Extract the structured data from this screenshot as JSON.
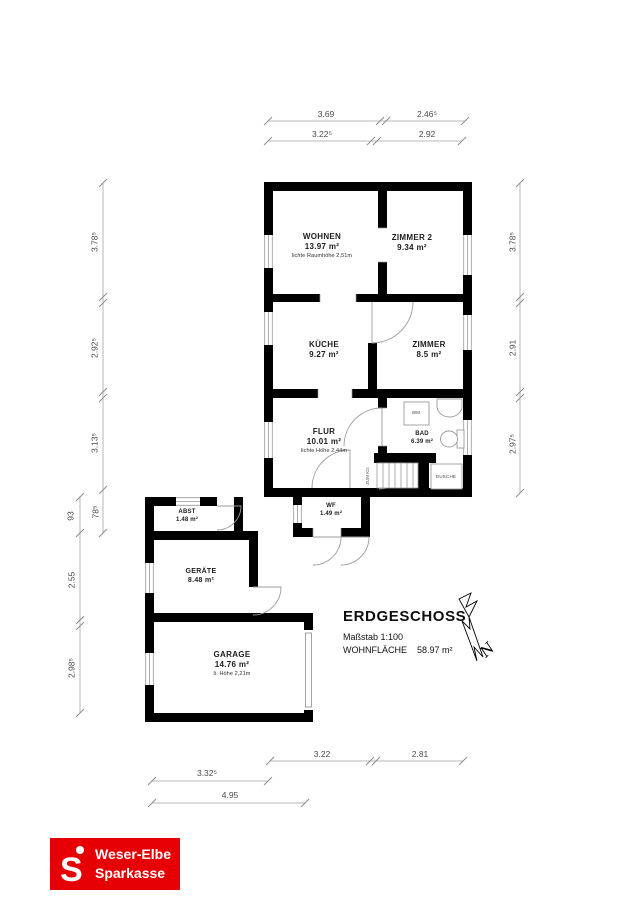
{
  "title_block": {
    "title": "ERDGESCHOSS",
    "scale": "Maßstab 1:100",
    "area_label": "WOHNFLÄCHE",
    "area_value": "58.97 m²"
  },
  "north_label": "N",
  "rooms": {
    "wohnen": {
      "name": "WOHNEN",
      "area": "13.97 m²",
      "note": "lichte Raumhöhe 2,51m"
    },
    "zimmer2": {
      "name": "ZIMMER 2",
      "area": "9.34 m²"
    },
    "kueche": {
      "name": "KÜCHE",
      "area": "9.27 m²"
    },
    "zimmer": {
      "name": "ZIMMER",
      "area": "8.5 m²"
    },
    "flur": {
      "name": "FLUR",
      "area": "10.01 m²",
      "note": "lichte Höhe 2,44m"
    },
    "bad": {
      "name": "BAD",
      "area": "6.39 m²"
    },
    "wf": {
      "name": "WF",
      "area": "1.49 m²"
    },
    "abst": {
      "name": "ABST",
      "area": "1.48 m²"
    },
    "geraete": {
      "name": "GERÄTE",
      "area": "8.48 m²"
    },
    "garage": {
      "name": "GARAGE",
      "area": "14.76 m²",
      "note": "li. Höhe 2,21m"
    }
  },
  "fixtures": {
    "washer": "WM",
    "shower": "DUSCHE",
    "stairs_note": "ZUM KG"
  },
  "dimensions": {
    "top_row1": [
      "3.69",
      "2.46⁵"
    ],
    "top_row2": [
      "3.22⁵",
      "2.92"
    ],
    "left_outer": [
      "3.78⁵",
      "2.92⁵",
      "3.13⁵",
      "78⁵"
    ],
    "left_inner": [
      "93",
      "2.55",
      "2.98⁵"
    ],
    "right": [
      "3.78⁵",
      "2.91",
      "2.97⁵"
    ],
    "bottom_row1": [
      "3.22",
      "2.81"
    ],
    "bottom_row2": "3.32⁵",
    "bottom_row3": "4.95"
  },
  "logo": {
    "symbol": "S",
    "line1": "Weser-Elbe",
    "line2": "Sparkasse"
  },
  "colors": {
    "walls": "#000000",
    "brand_red": "#e60005",
    "dim_lines": "#a3a3a3"
  }
}
